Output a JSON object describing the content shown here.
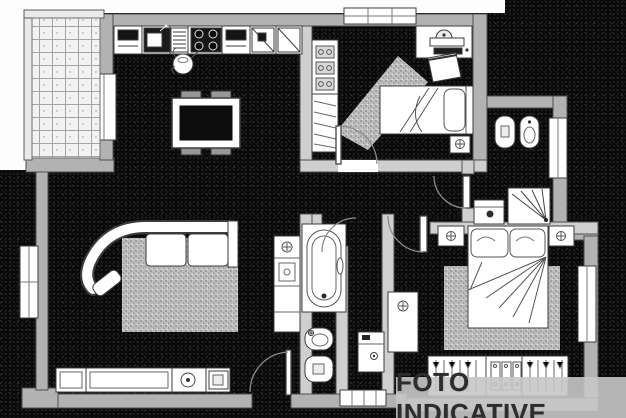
{
  "watermark": {
    "text": "FOTO INDICATIVE"
  },
  "colors": {
    "floor": "#0a0a0a",
    "exterior_wall": "#b2b2b2",
    "interior_wall": "#cfcfcf",
    "furniture_fill": "#ffffff",
    "line": "#3c3c3c",
    "rug": "#bdbdbd",
    "watermark_bg": "#c7c7c7",
    "watermark_text": "#2d2d2d"
  },
  "plan": {
    "type": "apartment-floor-plan",
    "rooms": [
      {
        "name": "balcony",
        "features": [
          "tiled-floor",
          "railing",
          "balcony-door"
        ]
      },
      {
        "name": "kitchen",
        "features": [
          "counter",
          "sink",
          "drainer",
          "stove-4-burners",
          "cabinets",
          "kettle",
          "dining-table",
          "four-chairs"
        ]
      },
      {
        "name": "living-room",
        "features": [
          "curved-sofa",
          "rug",
          "sideboard",
          "speaker",
          "appliance-column",
          "window",
          "entrance-door"
        ]
      },
      {
        "name": "bedroom-1",
        "features": [
          "single-bed",
          "desk",
          "chair",
          "wardrobe",
          "nightstand",
          "rug",
          "window"
        ]
      },
      {
        "name": "bathroom-1",
        "features": [
          "toilet",
          "bidet",
          "shower",
          "washbasin",
          "window"
        ]
      },
      {
        "name": "bathroom-2",
        "features": [
          "bathtub",
          "washbasin",
          "toilet"
        ]
      },
      {
        "name": "hallway",
        "features": [
          "washing-machine",
          "entrance-threshold",
          "doors"
        ]
      },
      {
        "name": "master-bedroom",
        "features": [
          "double-bed",
          "two-nightstands",
          "dresser",
          "rug",
          "wardrobe-with-hangers",
          "window"
        ]
      }
    ]
  }
}
